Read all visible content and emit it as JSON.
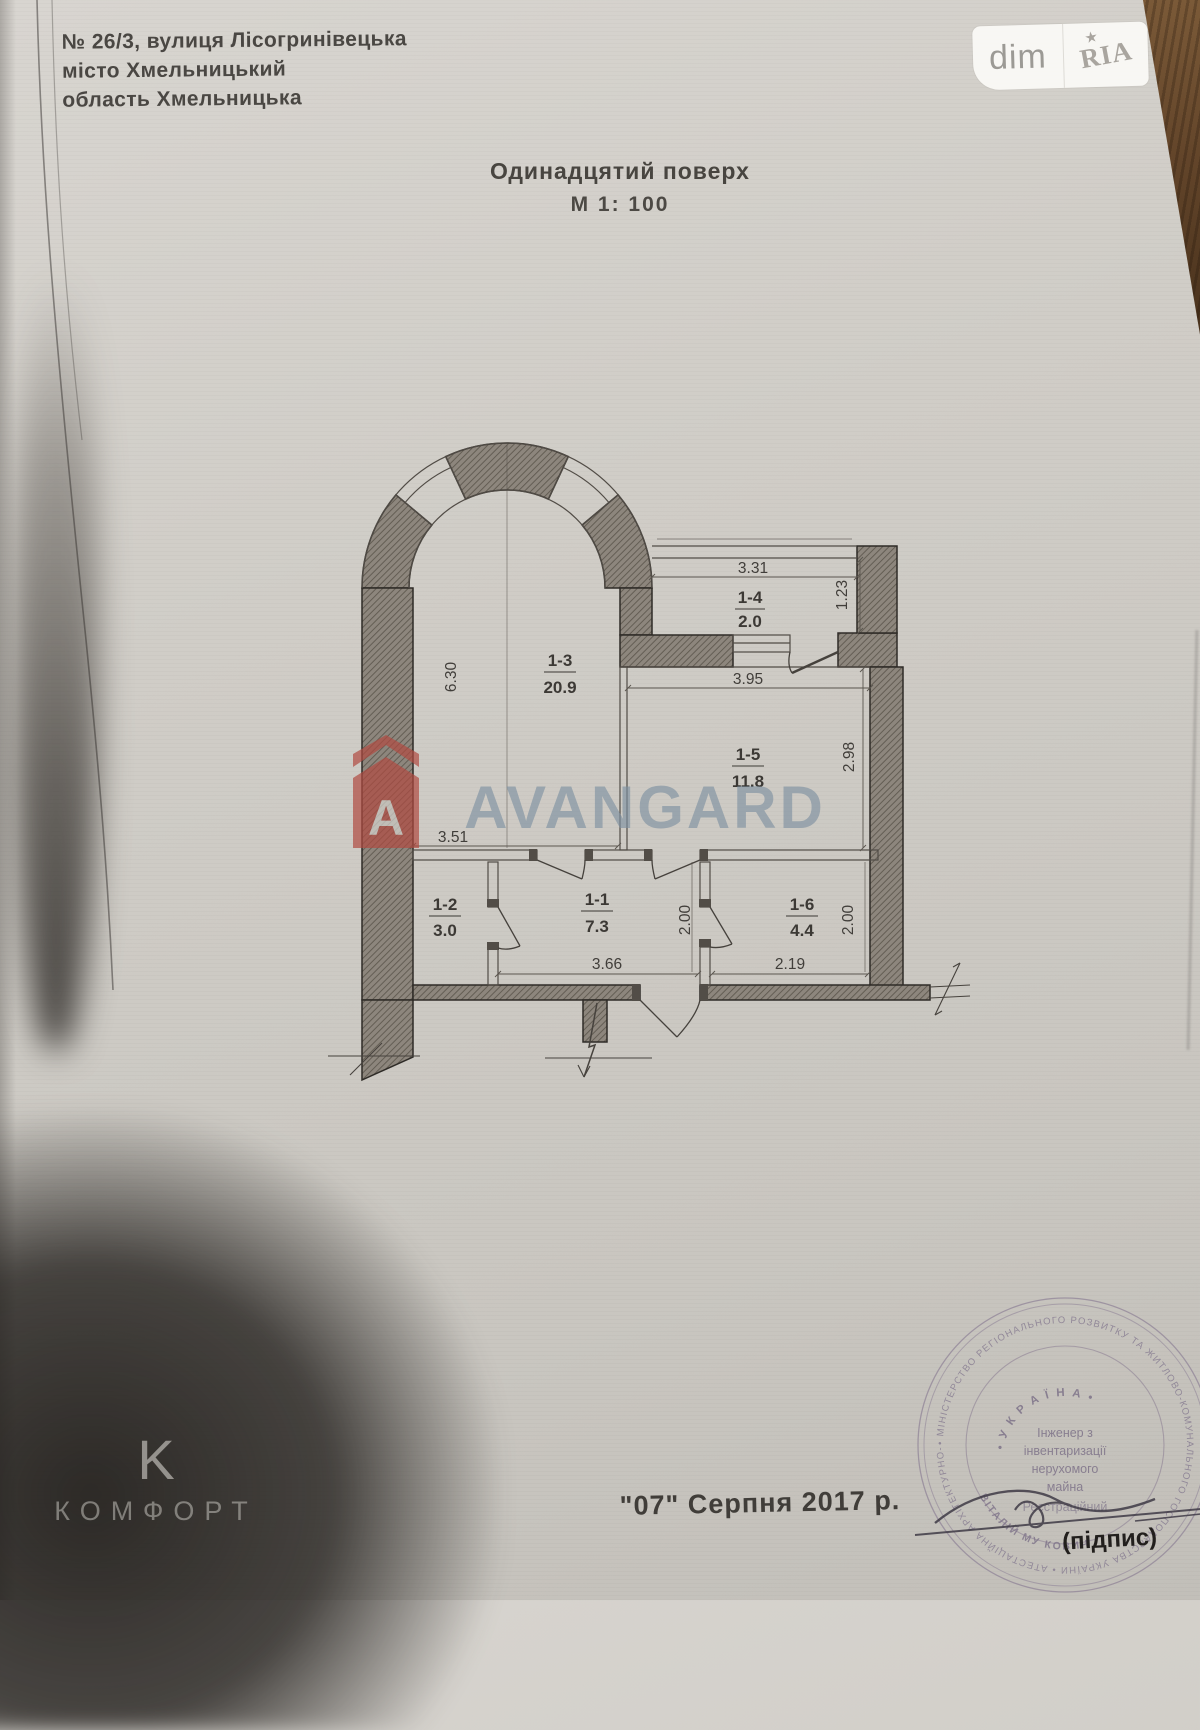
{
  "header": {
    "address1": "№ 26/3, вулиця Лісогринівецька",
    "address2": "місто Хмельницький",
    "address3": "область Хмельницька",
    "title": "Одинадцятий поверх",
    "scale": "М 1: 100"
  },
  "badge": {
    "left": "dim",
    "right": "RIA",
    "star": "★"
  },
  "watermark": {
    "brand": "AVANGARD",
    "logo_letter": "A"
  },
  "komfort": {
    "logo_letter": "K",
    "label": "КОМФОРТ"
  },
  "footer": {
    "date": "\"07\"  Серпня 2017 р."
  },
  "plan": {
    "rooms": [
      {
        "id": "1-3",
        "area": "20.9"
      },
      {
        "id": "1-4",
        "area": "2.0"
      },
      {
        "id": "1-5",
        "area": "11.8"
      },
      {
        "id": "1-2",
        "area": "3.0"
      },
      {
        "id": "1-1",
        "area": "7.3"
      },
      {
        "id": "1-6",
        "area": "4.4"
      }
    ],
    "dims": {
      "living_h": "6.30",
      "living_w": "3.51",
      "balcony_w": "3.31",
      "balcony_h": "1.23",
      "kitchen_w": "3.95",
      "kitchen_h": "2.98",
      "hall_w": "3.66",
      "hall_h": "2.00",
      "bath_w": "2.19",
      "bath_h": "2.00"
    }
  },
  "stamp": {
    "ring": "• МІНІСТЕРСТВО РЕГІОНАЛЬНОГО РОЗВИТКУ ТА ЖИТЛОВО-КОМУНАЛЬНОГО ГОСПОДАРСТВА УКРАЇНИ • АТЕСТАЦІЙНА АРХІТЕКТУРНО-БУДІВЕЛЬНА КОМІСІЯ • КВАЛІФІКАЦІЙНИЙ СЕРТИФІКАТ",
    "country": "• У К Р А Ї Н А •",
    "line1": "Інженер з",
    "line2": "інвентаризації",
    "line3": "нерухомого",
    "line4": "майна",
    "line5": "Реєстраційний",
    "name_arc": "ВІТАЛІЙ МУ КОВИЧ",
    "signature_label": "(підпис)"
  },
  "colors": {
    "paper": "#cfccc6",
    "wall": "#8d867d",
    "ink": "#3c3935",
    "watermark_blue": "#7c90a0",
    "logo_red": "#b14a41",
    "stamp_ink": "#8d8095",
    "wood": "#6f4e2d"
  }
}
